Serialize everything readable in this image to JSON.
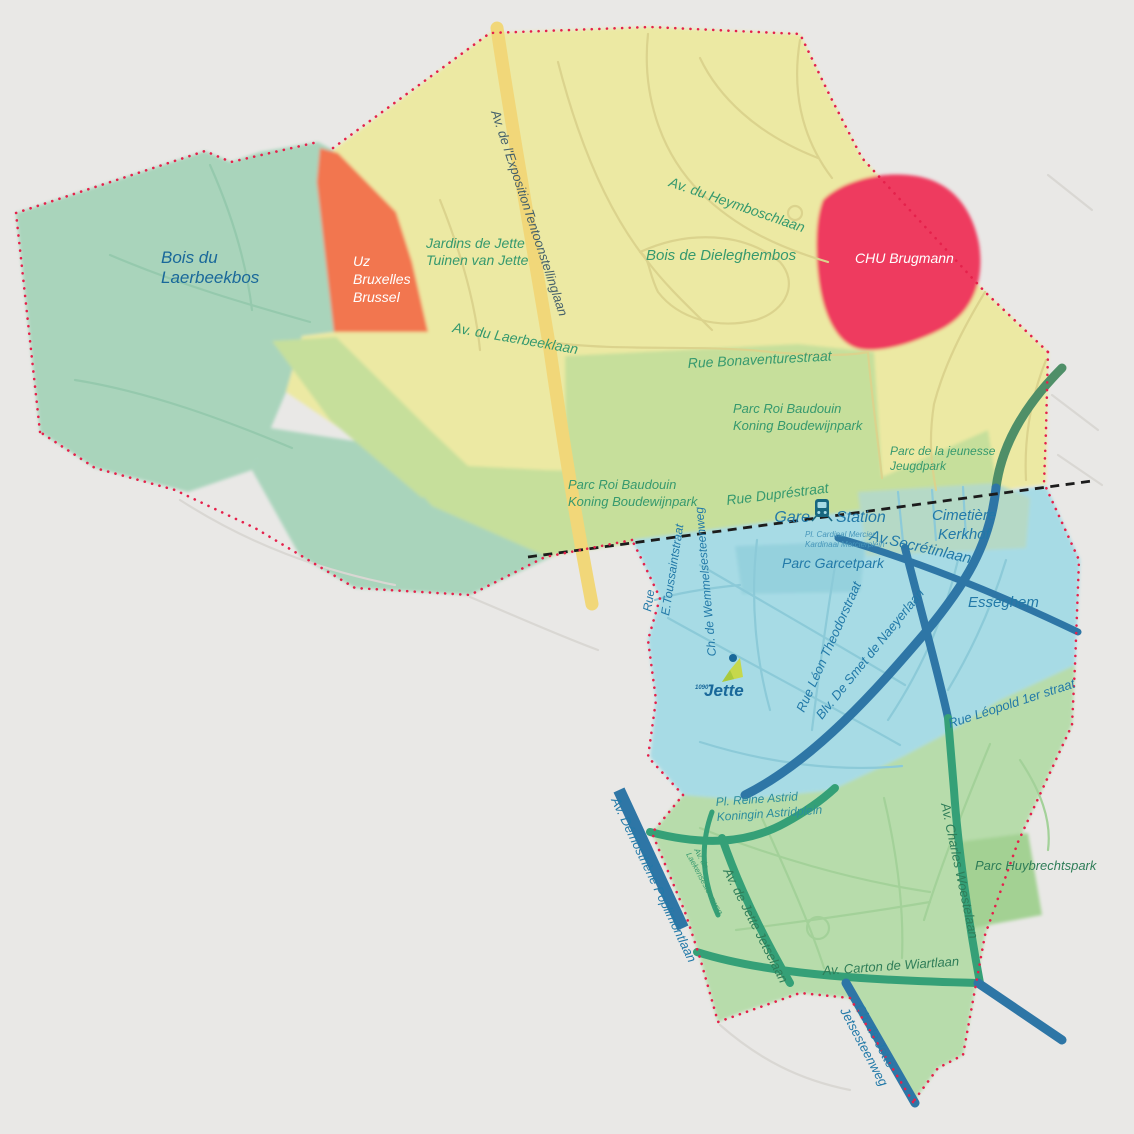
{
  "map": {
    "title": "Jette municipality stylized map",
    "zones": {
      "laerbeekbos": {
        "label_lines": [
          "Bois du",
          "Laerbeekbos"
        ]
      },
      "uz": {
        "label_lines": [
          "Uz",
          "Bruxelles",
          "Brussel"
        ]
      },
      "jardins": {
        "label_lines": [
          "Jardins de Jette",
          "Tuinen van Jette"
        ]
      },
      "dieleghembos": {
        "label": "Bois de Dieleghembos"
      },
      "chu": {
        "label": "CHU Brugmann"
      },
      "parc_roi_upper": {
        "label_lines": [
          "Parc Roi Baudouin",
          "Koning Boudewijnpark"
        ]
      },
      "parc_roi_lower": {
        "label_lines": [
          "Parc Roi Baudouin",
          "Koning Boudewijnpark"
        ]
      },
      "parc_jeunesse": {
        "label_lines": [
          "Parc de la jeunesse",
          "Jeugdpark"
        ]
      },
      "cimetiere": {
        "label_lines": [
          "Cimetière",
          "Kerkhof"
        ]
      },
      "parc_garcet": {
        "label": "Parc Garcetpark"
      },
      "esseghem": {
        "label": "Esseghem"
      },
      "parc_huybrechts": {
        "label": "Parc Huybrechtspark"
      },
      "reine_astrid": {
        "label_lines": [
          "Pl. Reine Astrid",
          "Koningin Astridplein"
        ]
      }
    },
    "streets": {
      "exposition": "Av. de l'ExpositionTentoonstellinglaan",
      "heymbosch": "Av. du Heymboschlaan",
      "laerbeeklaan": "Av. du Laerbeeklaan",
      "bonaventure": "Rue Bonaventurestraat",
      "dupre": "Rue Dupréstraat",
      "secretin": "Av.Secrétinlaan",
      "toussaint_1": "Rue",
      "toussaint_2": "E.Toussaintstraat",
      "wemmel": "Ch. de Wemmelsesteenweg",
      "leon_theodor": "Rue Léon Theodorstraat",
      "desmet": "Blv. De Smet de Naeyerlaan",
      "leopold": "Rue Léopold 1er straat",
      "demosthene": "Av. Démosthène Poplimontlaan",
      "laeken_lines": [
        "Av. de",
        "Laekensesteenweg"
      ],
      "jetselaan": "Av. de Jette Jetselaan",
      "woestelaan": "Av. Charles Woestelaan",
      "carton": "Av. Carton de Wiartlaan",
      "jetsesteenweg_lines": [
        "Ch. de Jette",
        "Jetsesteenweg"
      ]
    },
    "station": {
      "left": "Gare",
      "right": "Station",
      "sub_lines": [
        "Pl. Cardinal Mercier",
        "Kardinaal Mercierplein"
      ]
    },
    "logo": {
      "small": "1090",
      "name": "Jette"
    },
    "colors": {
      "background": "#e9e8e6",
      "zone_forest_teal": "#a9d4bb",
      "zone_yellow": "#ece9a3",
      "zone_orange": "#f2764f",
      "zone_red_chu": "#ee3b5f",
      "zone_park_green": "#c6df9b",
      "zone_blue": "#a7dbe5",
      "zone_bottom_green": "#b7dcab",
      "road_yellow": "#f1d779",
      "road_blue": "#2e76a6",
      "road_green": "#35a077",
      "boundary_red": "#e5214b",
      "railway_black": "#1c1c1c"
    }
  }
}
